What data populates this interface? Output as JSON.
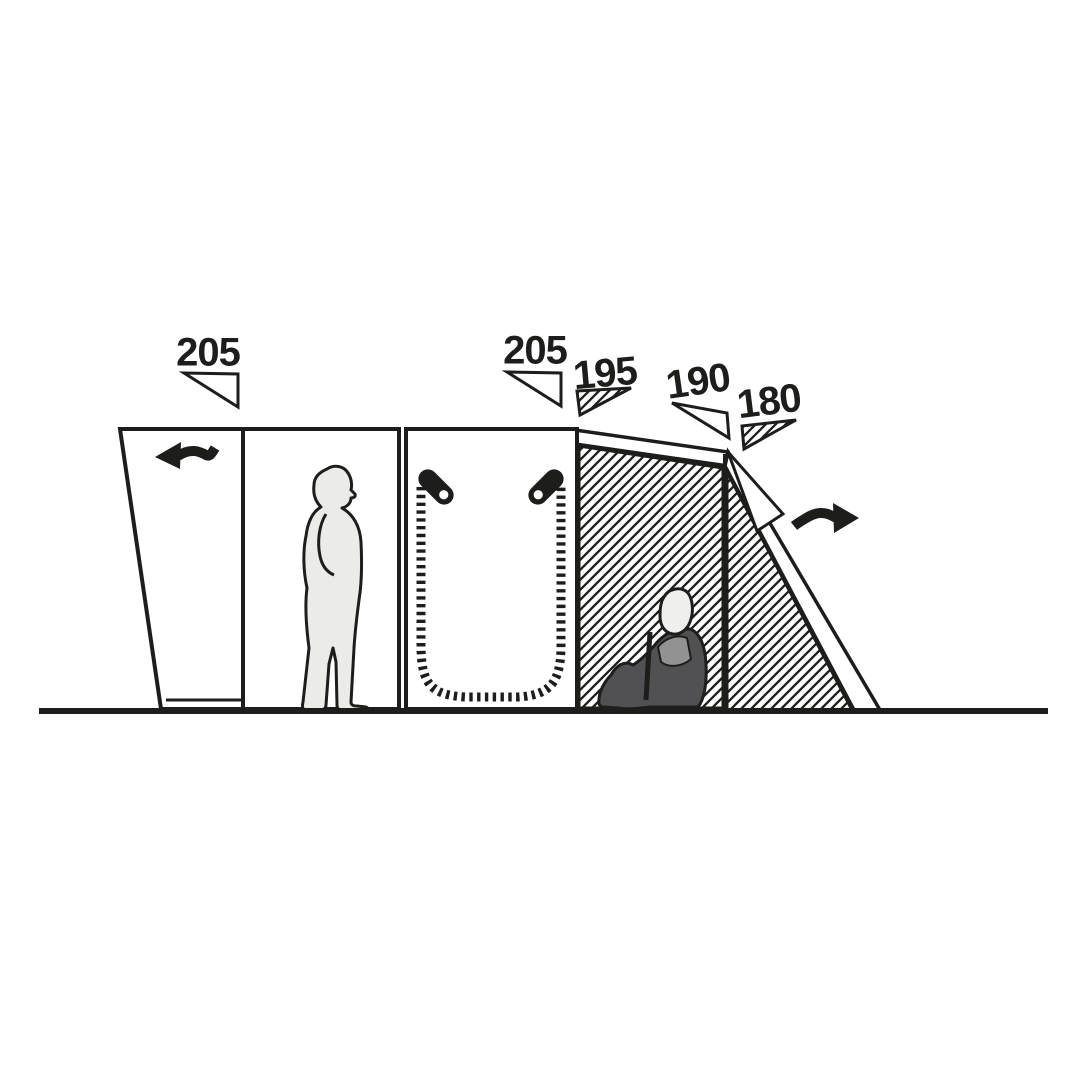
{
  "diagram": {
    "type": "tent-side-profile-height-diagram",
    "measurements": [
      {
        "id": "section-1-height",
        "value": "205"
      },
      {
        "id": "section-2-height",
        "value": "205"
      },
      {
        "id": "section-3-height",
        "value": "195"
      },
      {
        "id": "section-4-height",
        "value": "190"
      },
      {
        "id": "section-5-height",
        "value": "180"
      }
    ],
    "icons": {
      "airflow_left": "wavy-arrow-left",
      "airflow_right": "wavy-arrow-right",
      "zipper_pull_left": "zipper-pull-diagonal",
      "zipper_pull_right": "zipper-pull-diagonal-mirrored",
      "standing_person": "standing-person-silhouette",
      "seated_person": "seated-person-in-chair-silhouette"
    },
    "colors": {
      "outline": "#1d1d1b",
      "background": "#ffffff",
      "person_light": "#ebebea",
      "person_dark": "#515153",
      "person_mid": "#929292",
      "head_light": "#efefee"
    }
  }
}
